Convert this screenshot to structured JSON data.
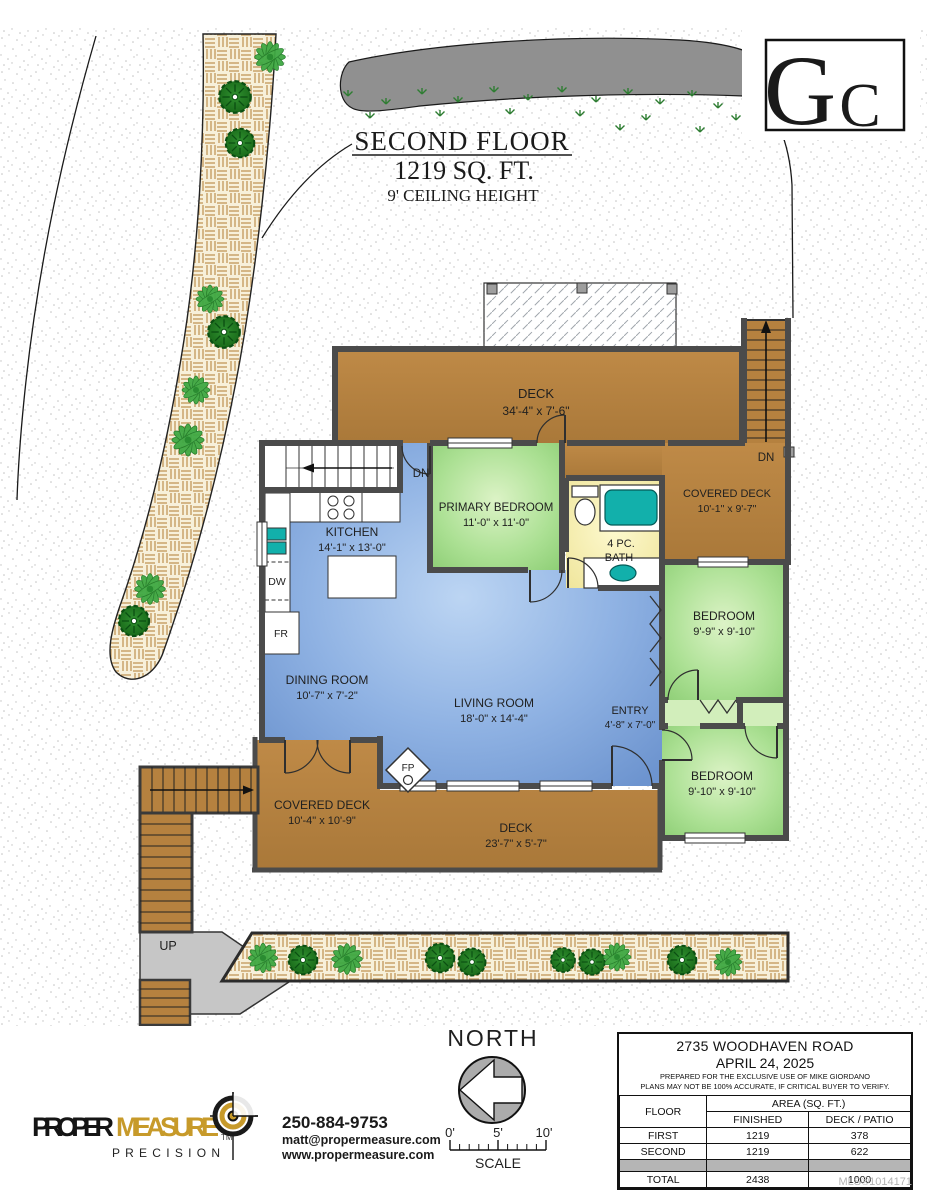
{
  "title": {
    "floor": "SECOND FLOOR",
    "area": "1219 SQ. FT.",
    "ceiling": "9' CEILING HEIGHT"
  },
  "builder_logo": {
    "g": "G",
    "c": "C"
  },
  "rooms": {
    "deck_top": {
      "name": "DECK",
      "dims": "34'-4\" x 7'-6\""
    },
    "covered_deck_top": {
      "name": "COVERED DECK",
      "dims": "10'-1\" x 9'-7\""
    },
    "primary": {
      "name": "PRIMARY BEDROOM",
      "dims": "11'-0\" x 11'-0\""
    },
    "bath": {
      "line1": "4 PC.",
      "line2": "BATH"
    },
    "kitchen": {
      "name": "KITCHEN",
      "dims": "14'-1\" x 13'-0\""
    },
    "bedroom1": {
      "name": "BEDROOM",
      "dims": "9'-9\" x 9'-10\""
    },
    "dining": {
      "name": "DINING ROOM",
      "dims": "10'-7\" x 7'-2\""
    },
    "living": {
      "name": "LIVING ROOM",
      "dims": "18'-0\" x 14'-4\""
    },
    "entry": {
      "name": "ENTRY",
      "dims": "4'-8\" x 7'-0\""
    },
    "bedroom2": {
      "name": "BEDROOM",
      "dims": "9'-10\" x 9'-10\""
    },
    "covered_deck_bottom": {
      "name": "COVERED DECK",
      "dims": "10'-4\" x 10'-9\""
    },
    "deck_bottom": {
      "name": "DECK",
      "dims": "23'-7\" x 5'-7\""
    }
  },
  "tags": {
    "dn_stairs": "DN",
    "dn_right": "DN",
    "up": "UP",
    "dw": "DW",
    "fr": "FR",
    "fp": "FP"
  },
  "compass": {
    "label": "NORTH"
  },
  "scalebar": {
    "t0": "0'",
    "t5": "5'",
    "t10": "10'",
    "label": "SCALE"
  },
  "brand": {
    "part1": "PROPER",
    "part2": "MEASURE",
    "tm": "TM",
    "sub": "P R E C I S I O N",
    "phone": "250-884-9753",
    "email": "matt@propermeasure.com",
    "web": "www.propermeasure.com"
  },
  "infobox": {
    "address": "2735 WOODHAVEN ROAD",
    "date": "APRIL 24, 2025",
    "note1": "PREPARED FOR THE EXCLUSIVE USE OF MIKE GIORDANO",
    "note2": "PLANS MAY NOT BE 100% ACCURATE, IF CRITICAL BUYER TO VERIFY.",
    "col_floor": "FLOOR",
    "col_area": "AREA (SQ. FT.)",
    "col_finished": "FINISHED",
    "col_deck": "DECK / PATIO",
    "rows": [
      {
        "floor": "FIRST",
        "finished": "1219",
        "deck": "378"
      },
      {
        "floor": "SECOND",
        "finished": "1219",
        "deck": "622"
      }
    ],
    "total": {
      "floor": "TOTAL",
      "finished": "2438",
      "deck": "1000"
    }
  },
  "mls": "MLS®1014171",
  "colors": {
    "wall": "#4b4b4b",
    "deck_brown": "#b5813f",
    "room_green": "#a9df92",
    "room_blue": "#8fb4e8",
    "bath_yellow": "#f4eda5",
    "fixture_teal": "#12b0ab"
  }
}
